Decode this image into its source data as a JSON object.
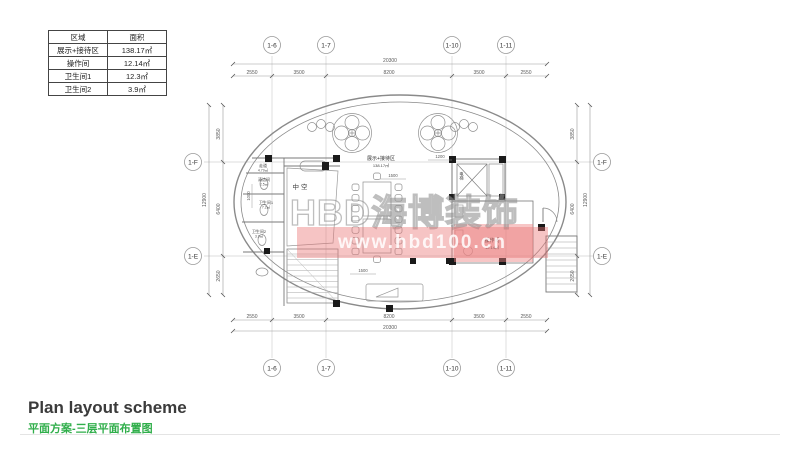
{
  "area_table": {
    "headers": [
      "区域",
      "面积"
    ],
    "rows": [
      {
        "name": "展示+接待区",
        "area": "138.17㎡"
      },
      {
        "name": "操作间",
        "area": "12.14㎡"
      },
      {
        "name": "卫生间1",
        "area": "12.3㎡"
      },
      {
        "name": "卫生间2",
        "area": "3.9㎡"
      }
    ]
  },
  "grid_axes": {
    "top": [
      "1-6",
      "1-7",
      "1-10",
      "1-11"
    ],
    "bottom": [
      "1-6",
      "1-7",
      "1-10",
      "1-11"
    ],
    "left": [
      "1-F",
      "1-E"
    ],
    "right": [
      "1-F",
      "1-E"
    ]
  },
  "dimensions": {
    "top_total": "20300",
    "top_segments": [
      "2550",
      "3500",
      "8200",
      "3500",
      "2550"
    ],
    "bottom_total": "20300",
    "bottom_segments": [
      "2550",
      "3500",
      "8200",
      "3500",
      "2550"
    ],
    "left_total": "12900",
    "left_segments": [
      "3850",
      "6400",
      "2650"
    ],
    "right_total": "12900",
    "right_segments": [
      "3850",
      "6400",
      "2650"
    ],
    "interior": {
      "table_width": "1500",
      "entry": "1200",
      "bottom": "1500",
      "left": "1000"
    }
  },
  "rooms": {
    "exhibition": {
      "name": "展示+接待区",
      "area": "138.17㎡"
    },
    "operation": {
      "name": "操作间",
      "area": "12.14㎡"
    },
    "void": {
      "name": "中空"
    },
    "corridor": {
      "name": "走道",
      "area": "4.79㎡"
    },
    "cleaning": {
      "name": "清洁间",
      "area": "2.5㎡"
    },
    "toilet1": {
      "name": "卫生间1",
      "area": "7.2㎡"
    },
    "toilet2": {
      "name": "卫生间2",
      "area": "3.9㎡"
    },
    "elevator": {
      "name": "电梯"
    }
  },
  "watermark": {
    "brand": "HBD海博装饰",
    "url": "www.hbd100.cn"
  },
  "footer": {
    "title_en": "Plan layout scheme",
    "title_zh": "平面方案-三层平面布置图"
  }
}
